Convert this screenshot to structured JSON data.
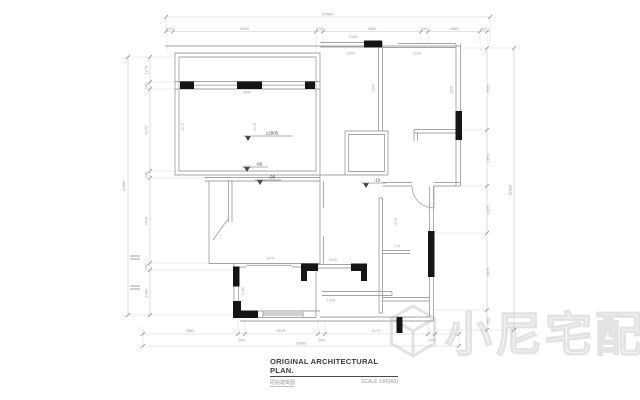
{
  "title_block": {
    "title": "ORIGINAL ARCHITECTURAL PLAN.",
    "subtitle_cn": "原始建筑图",
    "scale": "SCALE 1:80(A3)"
  },
  "watermark": {
    "text": "小尼宅配",
    "logo": "cube-logo-icon"
  },
  "levels": {
    "datum": "±2905",
    "a": "-90",
    "b": "-90",
    "c": "-10"
  },
  "dimensions": {
    "top_overall": "14500",
    "top": [
      "240",
      "4850",
      "230",
      "3385",
      "240",
      "3565",
      "245"
    ],
    "left_overall": "11880",
    "left": [
      "1175",
      "240",
      "5175",
      "240",
      "2975",
      "240",
      "1330"
    ],
    "right_overall": "11880",
    "right": [
      "2525",
      "1650",
      "1375",
      "2975",
      "650"
    ],
    "bottom_overall": "10080",
    "bottom": [
      "2880",
      "240",
      "3075",
      "240",
      "3170",
      "240"
    ],
    "interior": [
      "4850",
      "4175",
      "4175",
      "4850",
      "3090",
      "3190",
      "1485",
      "2900",
      "3525",
      "2075",
      "1730",
      "2040",
      "1530",
      "1175",
      "775"
    ]
  },
  "colors": {
    "wall_line": "#a3a3a3",
    "dim_line": "#c9c9c9",
    "wall_fill": "#151515",
    "dim_text": "#9a9a9a",
    "watermark": "#e3e3e3"
  }
}
